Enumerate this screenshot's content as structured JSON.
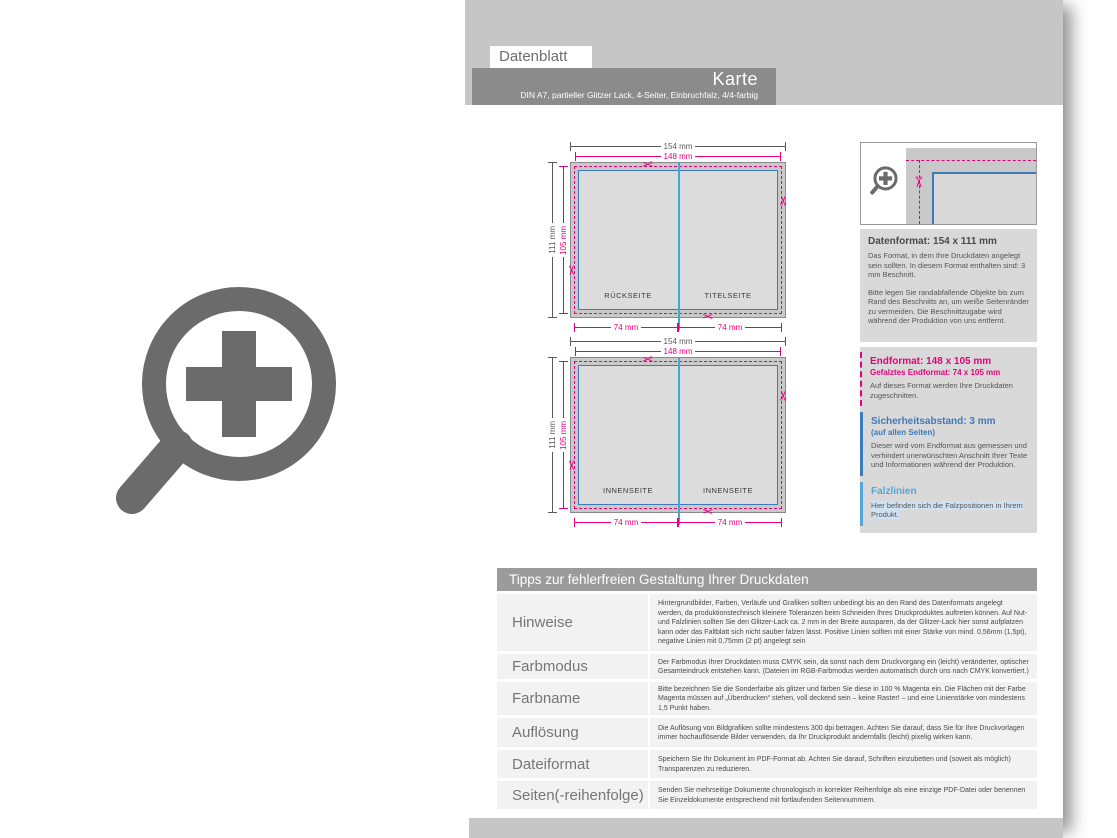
{
  "colors": {
    "magenta": "#e6007e",
    "safety-blue": "#3d7ab8",
    "fold-cyan": "#3fa9d5",
    "falz-blue": "#56a7d8",
    "panel-gray": "#c6c6c6",
    "header-gray": "#8b8b8b",
    "box-gray": "#d9d9d9",
    "table-header-gray": "#9b9b9b",
    "row-gray": "#f2f2f2",
    "icon-gray": "#6b6b6b",
    "highlight-blue": "#cfe2f3"
  },
  "header": {
    "tab": "Datenblatt",
    "title": "Karte",
    "subtitle": "DIN A7, partieller Glitzer Lack, 4-Seiter, Einbruchfalz, 4/4-farbig"
  },
  "diagram_dims": {
    "width_total": "154 mm",
    "width_trim": "148 mm",
    "height_total": "111 mm",
    "height_trim": "105 mm",
    "half_width_left": "74 mm",
    "half_width_right": "74 mm"
  },
  "diagram_top": {
    "left_page": "RÜCKSEITE",
    "right_page": "TITELSEITE"
  },
  "diagram_bottom": {
    "left_page": "INNENSEITE",
    "right_page": "INNENSEITE"
  },
  "info_sections": {
    "datenformat": {
      "title": "Datenformat: 154 x 111 mm",
      "body1": "Das Format, in dem Ihre Druckdaten angelegt sein sollten. In diesem Format enthalten sind: 3 mm Beschnitt.",
      "body2": "Bitte legen Sie randabfallende Objekte bis zum Rand des Beschnitts an, um weiße Seitenränder zu vermeiden. Die Beschnittzugabe wird während der Produktion von uns entfernt."
    },
    "endformat": {
      "title": "Endformat: 148 x 105 mm",
      "subtitle": "Gefalztes Endformat: 74 x 105 mm",
      "body": "Auf dieses Format werden Ihre Druckdaten zugeschnitten."
    },
    "sicherheitsabstand": {
      "title": "Sicherheitsabstand: 3 mm",
      "subtitle": "(auf allen Seiten)",
      "body": "Dieser wird vom Endformat aus gemessen und verhindert unerwünschten Anschnitt Ihrer Texte und Informationen während der Produktion."
    },
    "falzlinien": {
      "title": "Falzlinien",
      "body": "Hier befinden sich die Falzpositionen in Ihrem Produkt."
    }
  },
  "tips": {
    "title": "Tipps zur fehlerfreien Gestaltung Ihrer Druckdaten",
    "rows": [
      {
        "label": "Hinweise",
        "text": "Hintergrundbilder, Farben, Verläufe und Grafiken sollten unbedingt bis an den Rand des Datenformats angelegt werden, da produktionstechnisch kleinere Toleranzen beim Schneiden Ihres Druckproduktes auftreten können. Auf Nut- und Falzlinien sollten Sie den Glitzer-Lack ca. 2 mm in der Breite aussparen, da der Glitzer-Lack hier sonst aufplatzen kann oder das Faltblatt sich nicht sauber falzen lässt. Positive Linien sollten mit einer Stärke von mind. 0,56mm (1,5pt), negative Linien mit 0,75mm (2 pt) angelegt sein"
      },
      {
        "label": "Farbmodus",
        "text": "Der Farbmodus Ihrer Druckdaten muss CMYK sein, da sonst nach dem Druckvorgang ein (leicht) veränderter, optischer Gesamteindruck entstehen kann. (Dateien im RGB-Farbmodus werden automatisch durch uns nach CMYK konvertiert.)"
      },
      {
        "label": "Farbname",
        "text": "Bitte bezeichnen Sie die Sonderfarbe als glitzer und färben Sie diese in 100 % Magenta ein. Die Flächen mit der Farbe Magenta müssen auf „Überdrucken“ stehen, voll deckend sein – keine Raster! – und eine Linienstärke von mindestens 1,5 Punkt haben."
      },
      {
        "label": "Auflösung",
        "text": "Die Auflösung von Bildgrafiken sollte mindestens 300 dpi betragen. Achten Sie darauf, dass Sie für Ihre Druckvorlagen immer hochauflösende Bilder verwenden, da Ihr Druckprodukt andernfalls (leicht) pixelig wirken kann."
      },
      {
        "label": "Dateiformat",
        "text": "Speichern Sie Ihr Dokument im PDF-Format ab. Achten Sie darauf, Schriften einzubetten und (soweit als möglich) Transparenzen zu reduzieren."
      },
      {
        "label": "Seiten(-reihenfolge)",
        "text": "Senden Sie mehrseitige Dokumente chronologisch in korrekter Reihenfolge als eine einzige PDF-Datei oder benennen Sie Einzeldokumente entsprechend mit fortlaufenden Seitennummern."
      }
    ]
  }
}
